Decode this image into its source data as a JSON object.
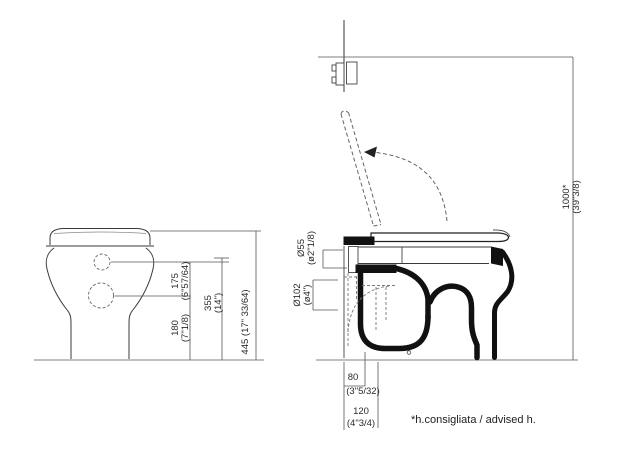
{
  "footnote": "*h.consigliata / advised h.",
  "front_view": {
    "dims": {
      "d175": {
        "mm": "175",
        "inch": "(6\"57/64)"
      },
      "d180": {
        "mm": "180",
        "inch": "(7\"1/8)"
      },
      "d355": {
        "mm": "355",
        "inch": "(14\")"
      },
      "d445": {
        "full": "445 (17\" 33/64)"
      }
    }
  },
  "side_view": {
    "dims": {
      "d1000": {
        "mm": "1000*",
        "inch": "(39\"3/8)"
      },
      "d55": {
        "mm": "Ø55",
        "inch": "(ø2\"1/8)"
      },
      "d102": {
        "mm": "Ø102",
        "inch": "(ø4\")"
      },
      "d80": {
        "mm": "80",
        "inch": "(3\"5/32)"
      },
      "d120": {
        "mm": "120",
        "inch": "(4\"3/4)"
      }
    }
  },
  "colors": {
    "line": "#3a3a3a",
    "section_fill": "#111111",
    "hidden_line": "#666666",
    "background": "#ffffff"
  }
}
